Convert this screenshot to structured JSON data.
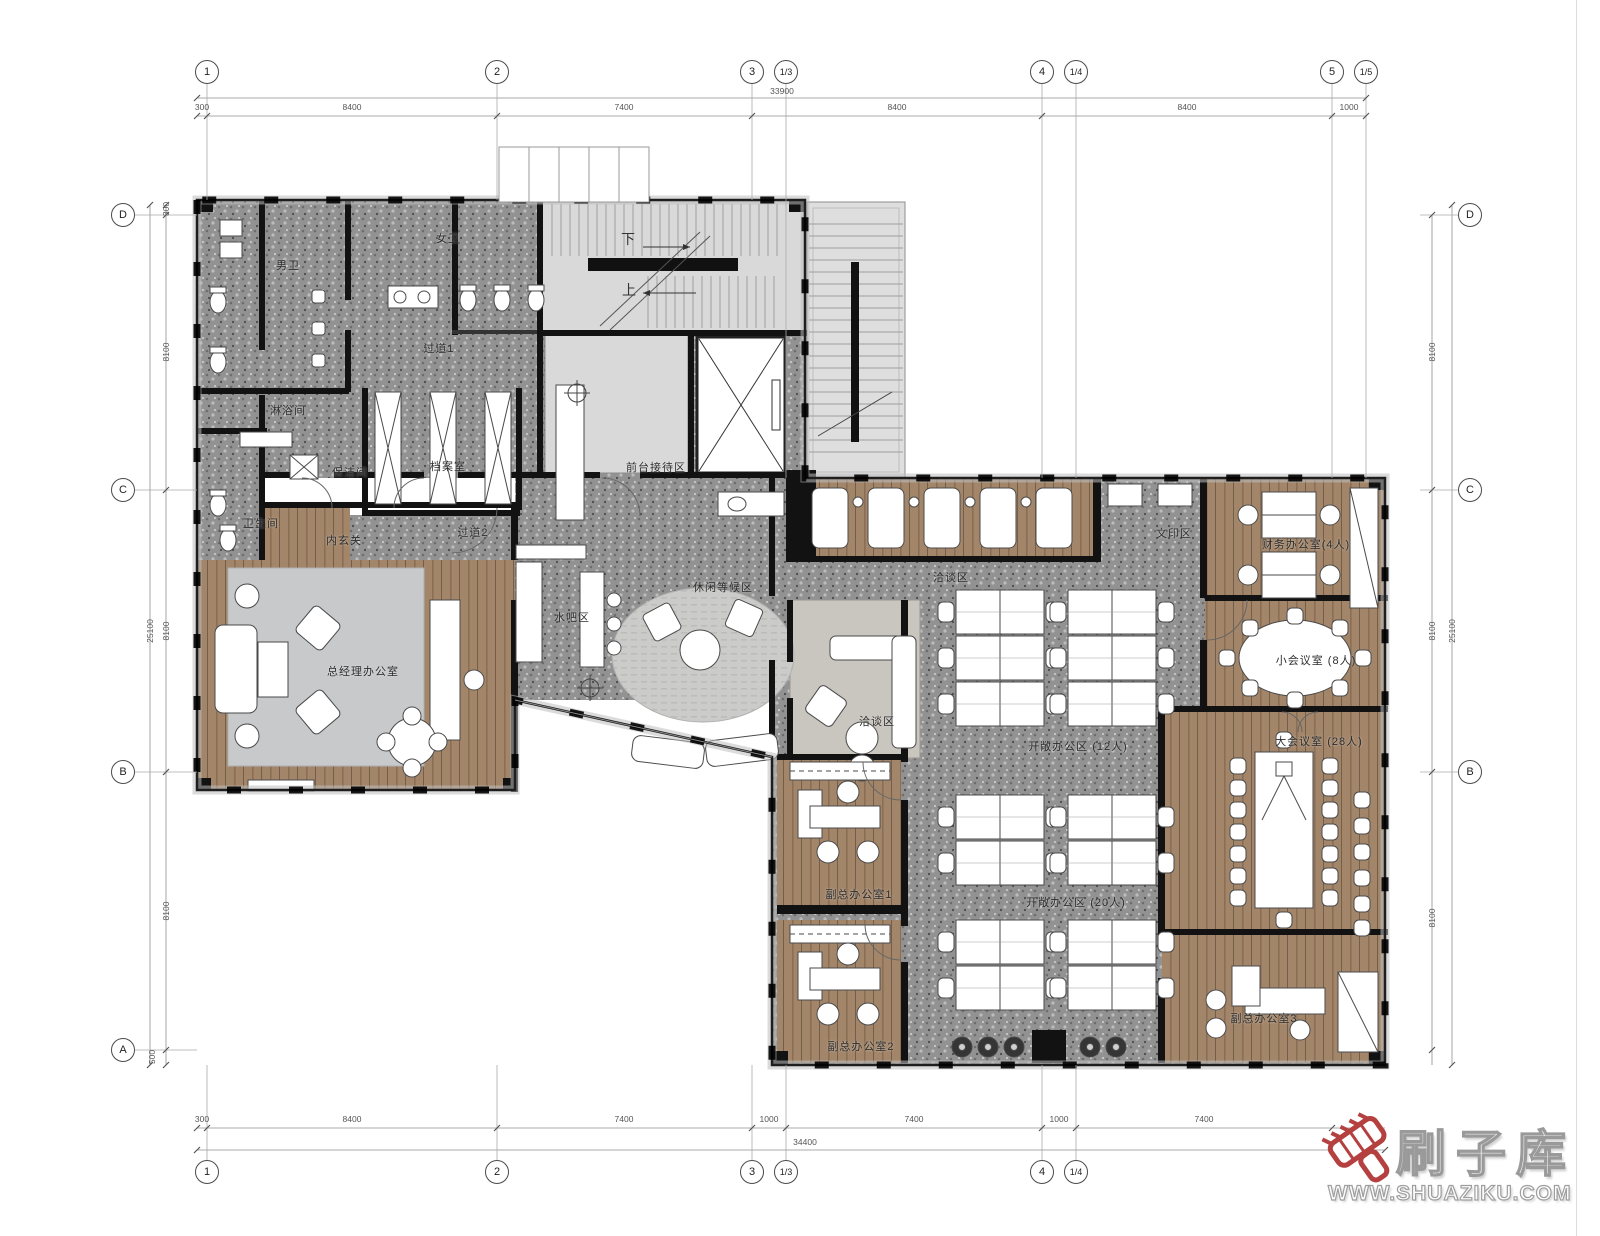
{
  "watermark": {
    "brand": "刷子库",
    "url": "WWW.SHUAZIKU.COM",
    "accent_color": "#b54040"
  },
  "stairs": {
    "down": "下",
    "up": "上"
  },
  "grid": {
    "top_bubbles": [
      "1",
      "2",
      "3",
      "1/3",
      "4",
      "1/4",
      "5",
      "1/5"
    ],
    "bottom_bubbles": [
      "1",
      "2",
      "3",
      "1/3",
      "4",
      "1/4"
    ],
    "left_bubbles": [
      "D",
      "C",
      "B",
      "A"
    ],
    "right_bubbles": [
      "D",
      "C",
      "B"
    ],
    "top_dims": [
      "300",
      "8400",
      "7400",
      "8400",
      "8400",
      "1000"
    ],
    "top_total": "33900",
    "bottom_dims": [
      "300",
      "8400",
      "7400",
      "1000",
      "7400",
      "1000",
      "7400"
    ],
    "bottom_total": "34400",
    "left_dims": [
      "300",
      "8100",
      "8100",
      "8100",
      "500"
    ],
    "left_total": "25100",
    "right_dims": [
      "8100",
      "8100",
      "8100"
    ],
    "right_total": "25100"
  },
  "rooms": [
    {
      "label": "男卫"
    },
    {
      "label": "女卫"
    },
    {
      "label": "过道1"
    },
    {
      "label": "淋浴间"
    },
    {
      "label": "保洁间"
    },
    {
      "label": "档案室"
    },
    {
      "label": "卫生间"
    },
    {
      "label": "内玄关"
    },
    {
      "label": "过道2"
    },
    {
      "label": "前台接待区"
    },
    {
      "label": "水吧区"
    },
    {
      "label": "休闲等候区"
    },
    {
      "label": "总经理办公室"
    },
    {
      "label": "洽谈区"
    },
    {
      "label": "文印区"
    },
    {
      "label": "财务办公室(4人)"
    },
    {
      "label": "小会议室 (8人)"
    },
    {
      "label": "大会议室 (28人)"
    },
    {
      "label": "洽谈区"
    },
    {
      "label": "开敞办公区 (12人)"
    },
    {
      "label": "开敞办公区 (20人)"
    },
    {
      "label": "副总办公室1"
    },
    {
      "label": "副总办公室2"
    },
    {
      "label": "副总办公室3"
    }
  ]
}
